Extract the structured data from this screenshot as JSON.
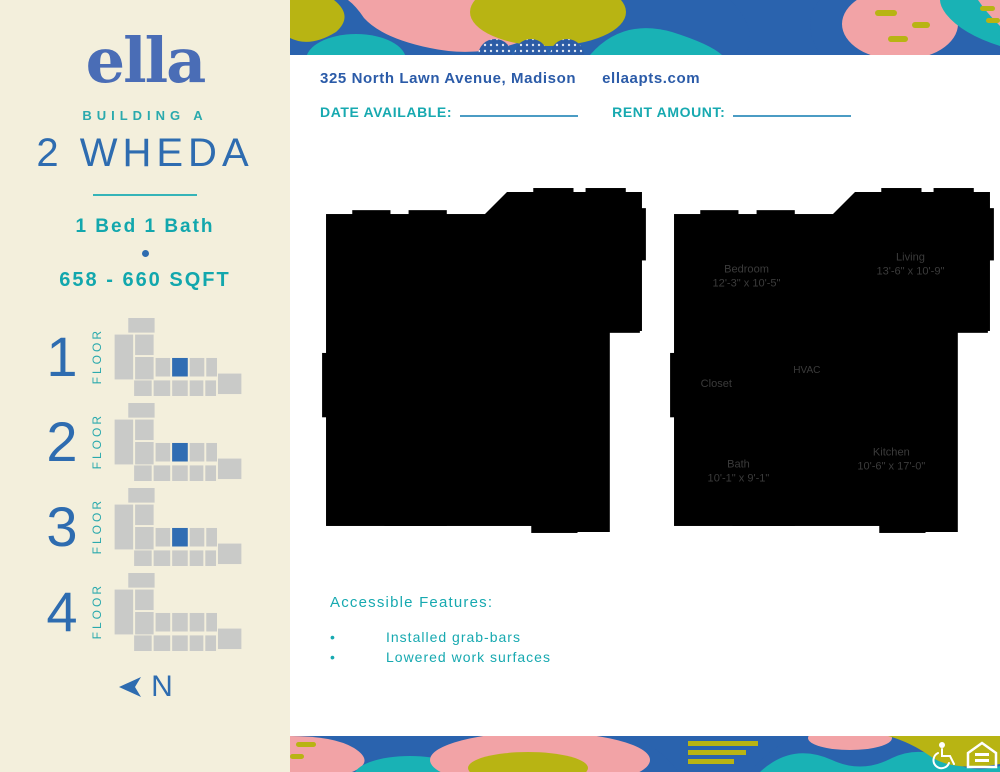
{
  "sidebar": {
    "logo": "ella",
    "building": "BUILDING A",
    "plan_name": "2 WHEDA",
    "beds_baths": "1 Bed 1 Bath",
    "sqft": "658 - 660 SQFT",
    "floor_label": "FLOOR",
    "floors": [
      {
        "number": "1",
        "highlighted": true
      },
      {
        "number": "2",
        "highlighted": true
      },
      {
        "number": "3",
        "highlighted": true
      },
      {
        "number": "4",
        "highlighted": false
      }
    ],
    "north_label": "N"
  },
  "header": {
    "address": "325 North Lawn Avenue, Madison",
    "website": "ellaapts.com",
    "date_available_label": "DATE AVAILABLE:",
    "date_available_value": "",
    "rent_amount_label": "RENT AMOUNT:",
    "rent_amount_value": ""
  },
  "floorplan": {
    "rooms": {
      "bedroom": {
        "name": "Bedroom",
        "dims": "12'-3\" x 10'-5\""
      },
      "living": {
        "name": "Living",
        "dims": "13'-6\" x 10'-9\""
      },
      "closet": {
        "name": "Closet"
      },
      "hvac": {
        "name": "HVAC"
      },
      "bath": {
        "name": "Bath",
        "dims": "10'-1\" x 9'-1\""
      },
      "kitchen": {
        "name": "Kitchen",
        "dims": "10'-6\" x 17'-0\""
      }
    }
  },
  "accessible": {
    "heading": "Accessible Features:",
    "items": [
      "Installed grab-bars",
      "Lowered work surfaces"
    ]
  },
  "icons": {
    "footer": [
      "wheelchair-icon",
      "equal-housing-icon"
    ]
  },
  "colors": {
    "sidebar_cream": "#f3efdc",
    "accent_teal": "#17a9b0",
    "accent_blue": "#2e6cb0",
    "logo_blue": "#4a6db6",
    "address_blue": "#2b5ba8",
    "band_blue": "#2a63ae",
    "band_teal": "#19b2b5",
    "band_pink": "#f2a3a6",
    "band_olive": "#b8b413",
    "unit_highlight_blue": "#2f6db3"
  }
}
